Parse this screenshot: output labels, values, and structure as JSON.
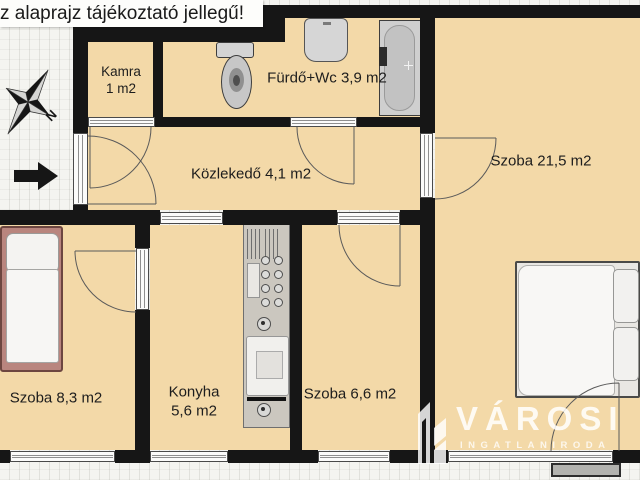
{
  "disclaimer": "z alaprajz tájékoztató jellegű!",
  "compass": {
    "north_label": "N"
  },
  "rooms": {
    "kamra": {
      "name": "Kamra",
      "area": "1 m2"
    },
    "furdo": {
      "label": "Fürdő+Wc 3,9 m2"
    },
    "kozlekedo": {
      "label": "Közlekedő 4,1 m2"
    },
    "szoba_nagy": {
      "label": "Szoba 21,5 m2"
    },
    "szoba_kis": {
      "label": "Szoba 8,3 m2"
    },
    "konyha": {
      "name": "Konyha",
      "area": "5,6 m2"
    },
    "szoba_kozepes": {
      "label": "Szoba 6,6 m2"
    }
  },
  "watermark": {
    "brand": "VÁROSI",
    "subtitle": "INGATLANIRODA"
  },
  "fixtures": [
    "toilet-icon",
    "washbasin-icon",
    "bathtub-icon",
    "kitchen-counter-icon",
    "single-bed-icon",
    "double-bed-icon",
    "compass-icon",
    "entrance-arrow-icon"
  ],
  "colors": {
    "floor": "#f3d9a8",
    "wall": "#161616",
    "background": "#f4f4f0",
    "bed_frame": "#b9857e",
    "watermark_text": "#ffffff"
  }
}
